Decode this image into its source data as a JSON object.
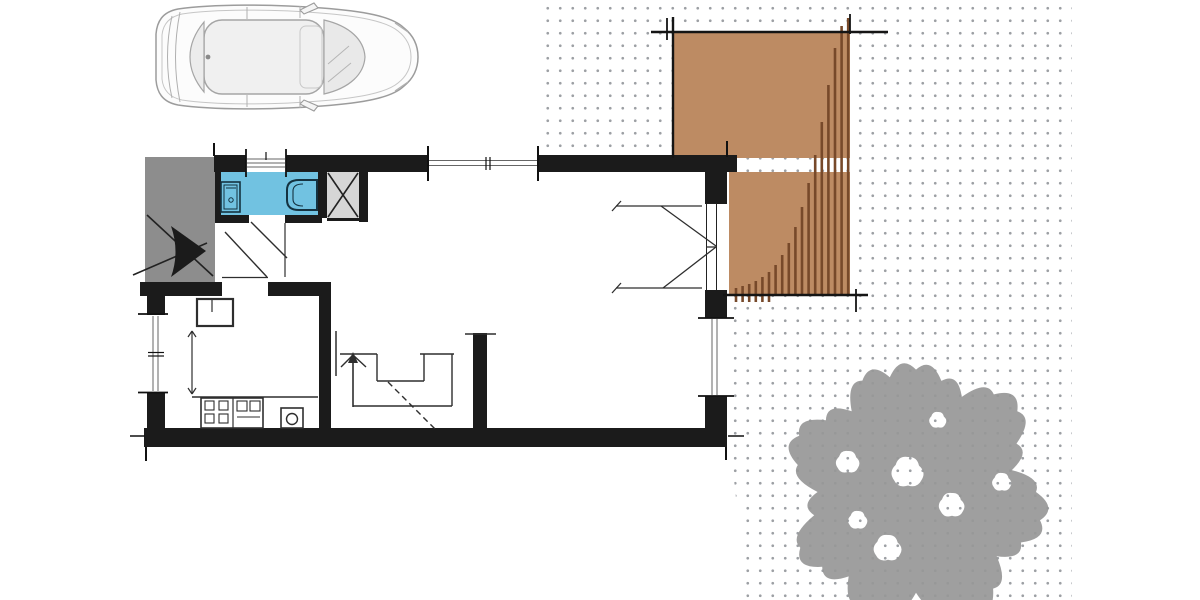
{
  "meta": {
    "description": "Hand-drawn architectural ground-floor plan of a small house, scanned and collaged: car top view at upper left, blue wet-room with bathtub, wooden slatted deck at upper right on dotted grid paper, large tree canopy at lower right. No text labels are visible in the image.",
    "canvas": {
      "width": 1200,
      "height": 600
    }
  },
  "colors": {
    "background": "#ffffff",
    "wall_black": "#1b1b1b",
    "thin_line": "#2e2e2e",
    "bathroom_blue": "#71c2e1",
    "fixture_blue_dark": "#143240",
    "canopy_gray": "#8d8d8d",
    "shower_gray": "#d6d6d6",
    "deck_brown": "#bd8b63",
    "slat_brown": "#77492a",
    "tree_gray": "#979797",
    "dot_gray": "#9da0a4",
    "car_line": "#9c9c9c",
    "car_glass": "#e9e9e9",
    "car_roof": "#f0f0f0"
  },
  "objects": {
    "car": {
      "name": "car-top-view",
      "style": "gray line drawing, nose pointing right"
    },
    "deck": {
      "name": "wood-deck",
      "slats": {
        "x_start": 736,
        "x_step": 6.6,
        "bottom_default": 295,
        "bottom_tick": 302,
        "tick_count": 6,
        "tops": [
          288,
          286,
          284,
          281,
          277,
          272,
          265,
          255,
          243,
          227,
          207,
          183,
          155,
          122,
          85,
          48,
          26,
          18
        ]
      }
    },
    "tree": {
      "name": "tree-canopy",
      "cx": 916,
      "cy": 492,
      "base_radius": 120,
      "bulge": 1.16,
      "lobes": [
        1.02,
        0.95,
        0.88,
        1.04,
        1.08,
        0.93,
        0.82,
        1.0,
        1.06,
        0.97,
        0.86,
        1.03,
        1.1,
        0.94,
        0.84,
        0.99,
        1.05,
        0.9,
        1.0,
        1.07,
        0.87,
        0.82,
        1.01,
        1.08,
        0.96,
        0.86,
        1.03,
        0.98
      ],
      "holes": [
        {
          "cx": 848,
          "cy": 462,
          "r": 11
        },
        {
          "cx": 908,
          "cy": 472,
          "r": 15
        },
        {
          "cx": 952,
          "cy": 505,
          "r": 12
        },
        {
          "cx": 888,
          "cy": 548,
          "r": 13
        },
        {
          "cx": 1002,
          "cy": 482,
          "r": 9
        },
        {
          "cx": 938,
          "cy": 420,
          "r": 8
        },
        {
          "cx": 858,
          "cy": 520,
          "r": 9
        }
      ]
    },
    "rooms": {
      "bathroom": {
        "fixtures": [
          "vanity-toilet",
          "bathtub"
        ],
        "fill": "blue"
      },
      "shower_unit": {
        "marking": "X-cross square"
      },
      "entry": {
        "canopy": true,
        "marking": "black entry arrow pointing right"
      },
      "kitchen": {
        "fixtures": [
          "refrigerator-box",
          "dimension-arrow",
          "counter",
          "stove-4-burner",
          "sink-round-basin"
        ]
      },
      "stairs": {
        "marking": "up arrow with winder steps and dashed cut line"
      },
      "living_room": {
        "fixtures": []
      }
    },
    "openings": {
      "top_wall_windows": 2,
      "left_wall_windows": 1,
      "right_wall_windows": 1,
      "french_door_to_deck": true,
      "interior_doors": 2
    }
  }
}
